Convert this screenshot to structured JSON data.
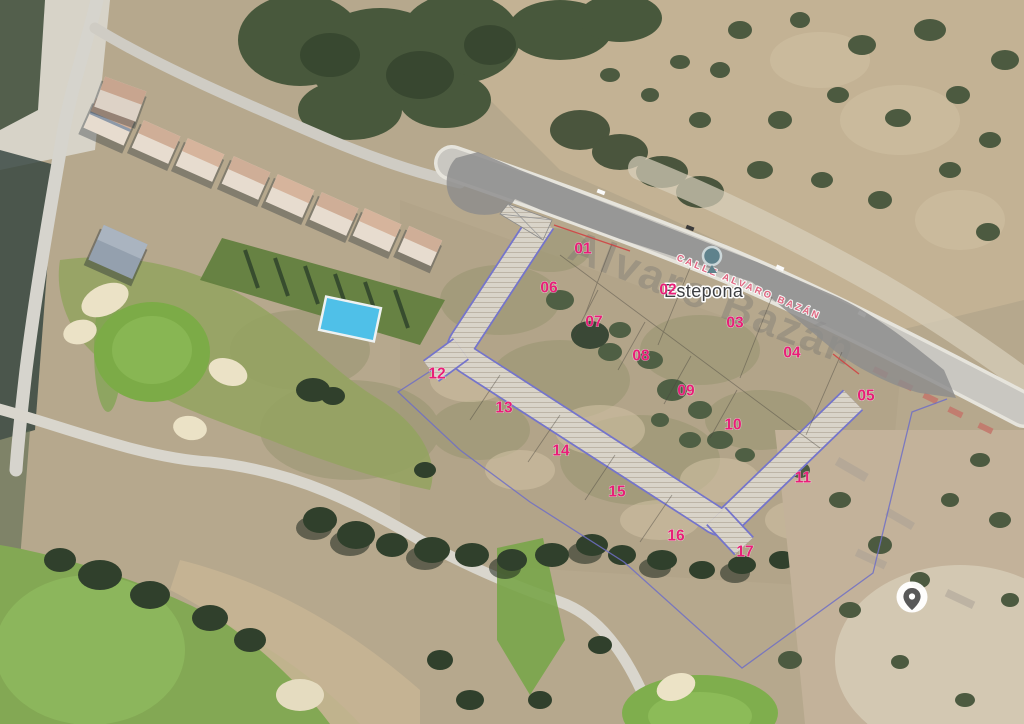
{
  "map": {
    "place_label": "Estepona",
    "road_label": "CALLE ALVARO BAZÁN",
    "watermark_label": "Alvaro Bazán"
  },
  "markers": [
    {
      "label": "01",
      "x": 583,
      "y": 249
    },
    {
      "label": "02",
      "x": 668,
      "y": 290
    },
    {
      "label": "03",
      "x": 735,
      "y": 323
    },
    {
      "label": "04",
      "x": 792,
      "y": 353
    },
    {
      "label": "05",
      "x": 866,
      "y": 396
    },
    {
      "label": "06",
      "x": 549,
      "y": 288
    },
    {
      "label": "07",
      "x": 594,
      "y": 322
    },
    {
      "label": "08",
      "x": 641,
      "y": 356
    },
    {
      "label": "09",
      "x": 686,
      "y": 391
    },
    {
      "label": "10",
      "x": 733,
      "y": 425
    },
    {
      "label": "11",
      "x": 803,
      "y": 478
    },
    {
      "label": "12",
      "x": 437,
      "y": 374
    },
    {
      "label": "13",
      "x": 504,
      "y": 408
    },
    {
      "label": "14",
      "x": 561,
      "y": 451
    },
    {
      "label": "15",
      "x": 617,
      "y": 492
    },
    {
      "label": "16",
      "x": 676,
      "y": 536
    },
    {
      "label": "17",
      "x": 745,
      "y": 552
    }
  ],
  "colors": {
    "marker_pink": "#e81f78",
    "road_label_pink": "#e0647f",
    "boundary_blue": "#6f6fc6",
    "platform_gray": "#8c8c8c",
    "red_boundary": "#cf4444"
  },
  "icons": {
    "location_pin": "pin-in-white-circle",
    "place_pin": "poi-balloon"
  }
}
